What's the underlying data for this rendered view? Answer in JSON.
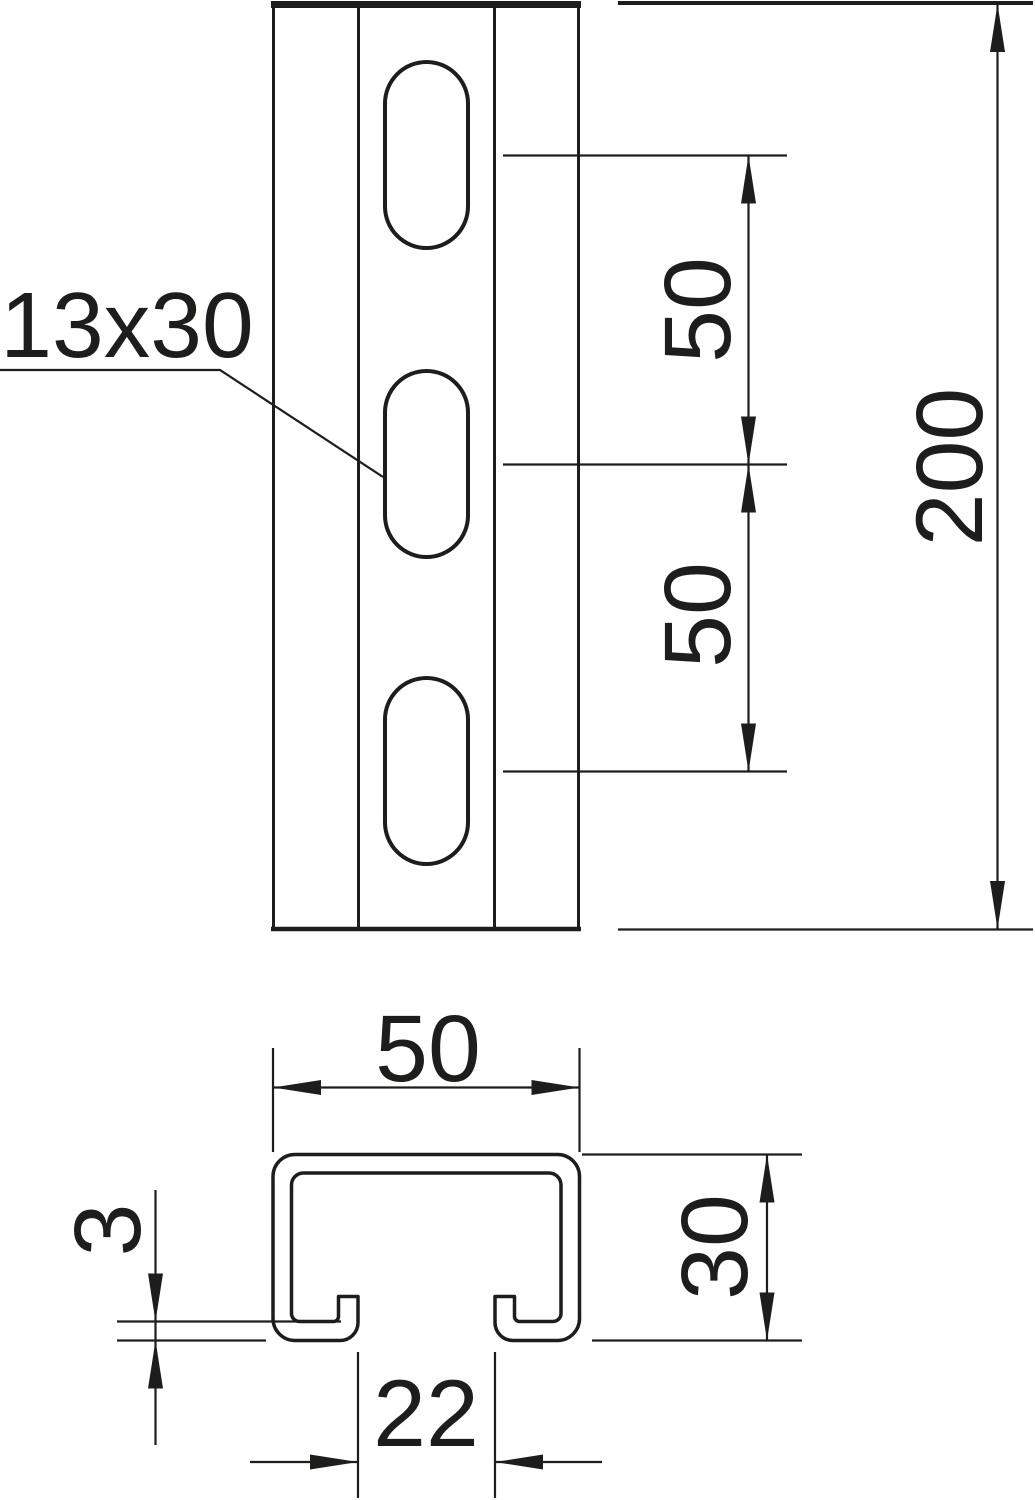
{
  "drawing": {
    "kind": "dimensioned technical drawing of a slotted C-profile mounting rail",
    "views": [
      "front view with slotted holes",
      "cross-section profile"
    ]
  },
  "colors": {
    "ink": "#1d1d1b",
    "paper": "#ffffff"
  },
  "callout": {
    "slot_size": "13x30"
  },
  "front_view": {
    "dim_slot_pitch_top": "50",
    "dim_slot_pitch_bottom": "50",
    "dim_length": "200"
  },
  "section_view": {
    "dim_width": "50",
    "dim_height": "30",
    "dim_thickness": "3",
    "dim_opening": "22"
  }
}
